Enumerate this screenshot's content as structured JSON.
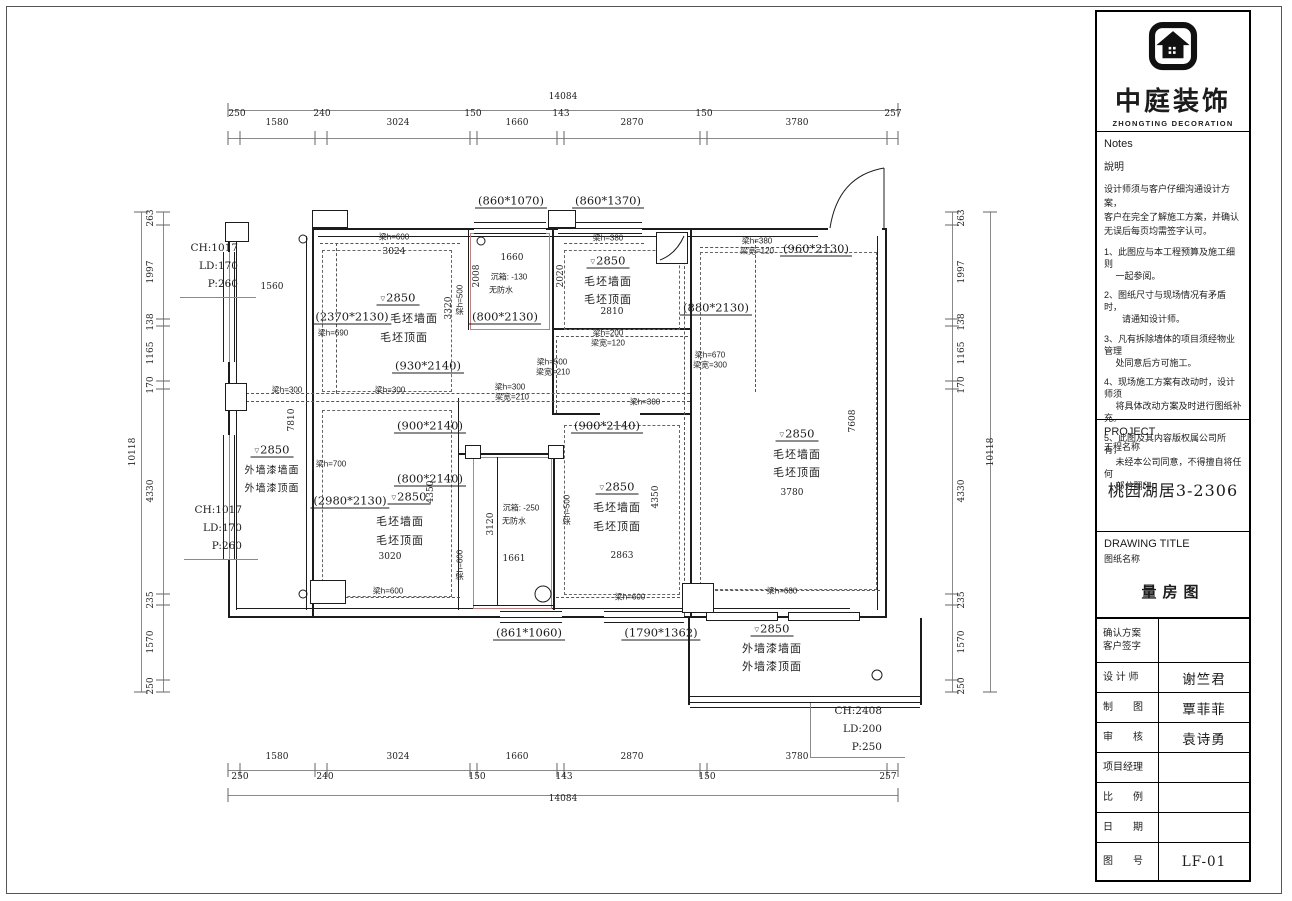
{
  "colors": {
    "line": "#1c1c1c",
    "bath_outline": "#c08080",
    "dim_text": "#222222"
  },
  "brand": {
    "name_cn": "中庭装饰",
    "name_en": "ZHONGTING DECORATION",
    "logo_icon": "house-logo"
  },
  "notes": {
    "header_en": "Notes",
    "header_cn": "說明",
    "intro": "设计师须与客户仔细沟通设计方案，\n客户在完全了解施工方案，并确认\n无误后每页均需签字认可。",
    "items": [
      "1、此图应与本工程预算及施工细则\n　 一起参阅。",
      "2、图纸尺寸与现场情况有矛盾时，\n　　请通知设计师。",
      "3、凡有拆除墙体的项目须经物业管理\n　 处同意后方可施工。",
      "4、现场施工方案有改动时，设计师须\n　 将具体改动方案及时进行图纸补充。",
      "5、此图及其内容版权属公司所有，\n　 未经本公司同意，不得擅自将任何\n　 部分翻印。"
    ]
  },
  "project": {
    "label_en": "PROJECT",
    "label_cn": "工程名称",
    "value": "桃园湖居3-2306"
  },
  "drawing": {
    "label_en": "DRAWING TITLE",
    "label_cn": "图纸名称",
    "value": "量房图"
  },
  "titleblock_rows": [
    {
      "label": "确认方案\n客户签字",
      "value": ""
    },
    {
      "label": "设 计 师",
      "value": "谢竺君"
    },
    {
      "label": "制　　图",
      "value": "覃菲菲"
    },
    {
      "label": "审　　核",
      "value": "袁诗勇"
    },
    {
      "label": "项目经理",
      "value": ""
    },
    {
      "label": "比　　例",
      "value": ""
    },
    {
      "label": "日　　期",
      "value": ""
    },
    {
      "label": "图　　号",
      "value": "LF-01"
    }
  ],
  "plan": {
    "dims_h": {
      "overall": "14084",
      "segments": [
        "250",
        "1580",
        "240",
        "3024",
        "150",
        "1660",
        "143",
        "2870",
        "150",
        "3780",
        "257"
      ]
    },
    "dims_v": {
      "overall": "10118",
      "segments": [
        "263",
        "1997",
        "138",
        "1165",
        "170",
        "4330",
        "235",
        "1570",
        "250"
      ]
    },
    "annotations": {
      "win_left_top": "CH:1017\nLD:170\nP:260",
      "win_left_bottom": "CH:1017\nLD:170\nP:260",
      "win_bottom_right": "CH:2408\nLD:200\nP:250"
    },
    "openings": {
      "w860a": "(860*1070)",
      "w860b": "(860*1370)",
      "d960": "(960*2130)",
      "d880": "(880*2130)",
      "d800s": "(800*2130)",
      "d930": "(930*2140)",
      "d900": "(900*2140)",
      "d800": "(800*2140)",
      "d2370": "(2370*2130)",
      "d2980": "(2980*2130)",
      "w861": "(861*1060)",
      "w1790": "(1790*1362)"
    },
    "beams": {
      "h600": "梁h=600",
      "h380": "梁h=380",
      "h690": "梁h=690",
      "h500": "梁h=500",
      "h300": "梁h=300",
      "h200": "梁h=200",
      "h670": "梁h=670",
      "h700": "梁h=700",
      "h680": "梁h=680",
      "w120": "梁宽=120",
      "w210": "梁宽=210",
      "w300": "梁宽=300"
    },
    "labels": {
      "level": "2850",
      "rough_wall": "毛坯墙面",
      "rough_ceiling": "毛坯顶面",
      "ext_paint_wall": "外墙漆墙面",
      "ext_paint_ceiling": "外墙漆顶面",
      "sunken1": "沉箱: -130",
      "sunken2": "沉箱: -250",
      "no_waterproof": "无防水"
    },
    "inner_dims": {
      "d3024": "3024",
      "d1560": "1560",
      "d2008": "2008",
      "d1660": "1660",
      "d2810": "2810",
      "d2020": "2020",
      "d3320": "3320",
      "d7810": "7810",
      "d7608": "7608",
      "d3020": "3020",
      "d2863": "2863",
      "d1661": "1661",
      "d3120": "3120",
      "d4350": "4350",
      "d3780": "3780"
    }
  }
}
